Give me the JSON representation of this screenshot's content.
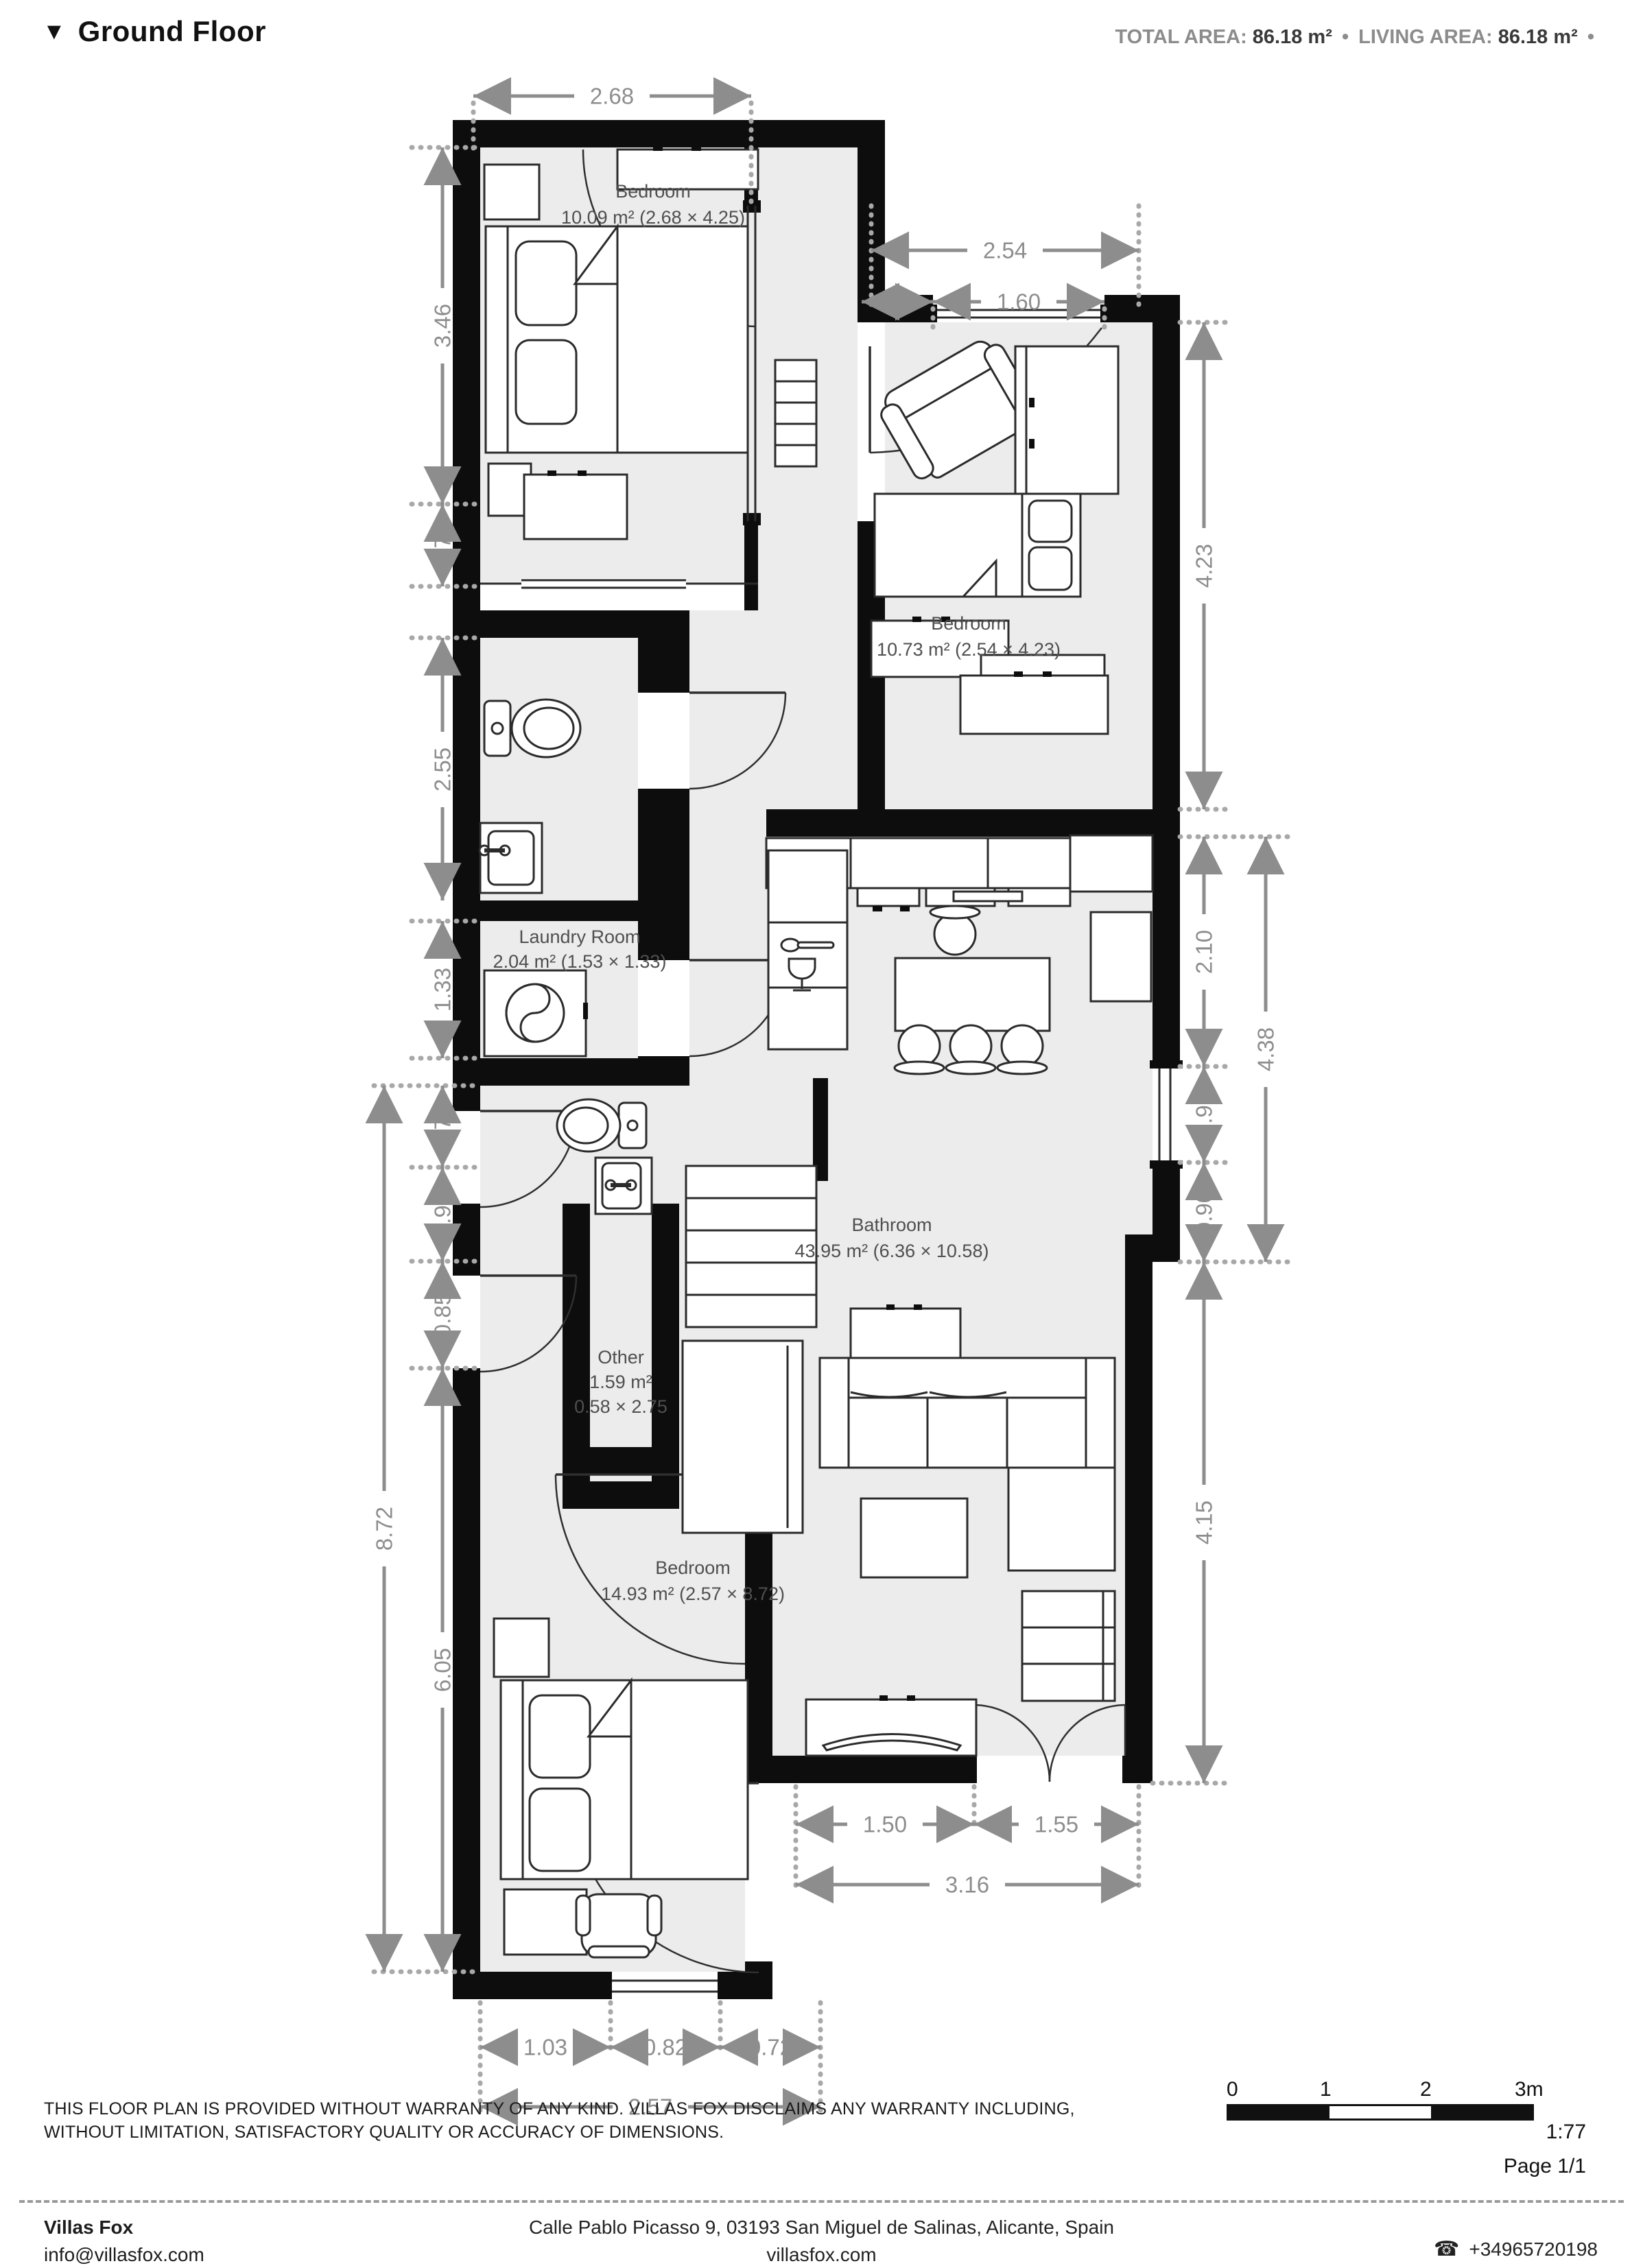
{
  "header": {
    "marker": "▼",
    "title": "Ground Floor",
    "total_label": "TOTAL AREA:",
    "total_value": "86.18 m²",
    "sep": "•",
    "living_label": "LIVING AREA:",
    "living_value": "86.18 m²",
    "trailing_sep": "•"
  },
  "rooms": [
    {
      "name": "Bedroom",
      "size": "10.09 m² (2.68 × 4.25)"
    },
    {
      "name": "Bedroom",
      "size": "10.73 m² (2.54 × 4.23)"
    },
    {
      "name": "Laundry Room",
      "size": "2.04 m² (1.53 × 1.33)"
    },
    {
      "name": "Bathroom",
      "size": "43.95 m² (6.36 × 10.58)"
    },
    {
      "name": "Other",
      "size": "1.59 m²",
      "size2": "0.58 × 2.75"
    },
    {
      "name": "Bedroom",
      "size": "14.93 m² (2.57 × 8.72)"
    }
  ],
  "dims": [
    {
      "v": "2.68"
    },
    {
      "v": "2.54"
    },
    {
      "v": "0.69"
    },
    {
      "v": "1.60"
    },
    {
      "v": "3.46"
    },
    {
      "v": "0.78"
    },
    {
      "v": "2.55"
    },
    {
      "v": "1.33"
    },
    {
      "v": "0.79"
    },
    {
      "v": "0.91"
    },
    {
      "v": "0.85"
    },
    {
      "v": "6.05"
    },
    {
      "v": "8.72"
    },
    {
      "v": "4.23"
    },
    {
      "v": "2.10"
    },
    {
      "v": "0.91"
    },
    {
      "v": "0.90"
    },
    {
      "v": "4.38"
    },
    {
      "v": "4.15"
    },
    {
      "v": "1.50"
    },
    {
      "v": "1.55"
    },
    {
      "v": "3.16"
    },
    {
      "v": "1.03"
    },
    {
      "v": "0.82"
    },
    {
      "v": "0.72"
    },
    {
      "v": "2.57"
    }
  ],
  "footer": {
    "disclaimer_line1": "THIS FLOOR PLAN IS PROVIDED WITHOUT WARRANTY OF ANY KIND. VILLAS FOX DISCLAIMS ANY WARRANTY INCLUDING,",
    "disclaimer_line2": "WITHOUT LIMITATION, SATISFACTORY QUALITY OR ACCURACY OF DIMENSIONS.",
    "scale_tick0": "0",
    "scale_tick1": "1",
    "scale_tick2": "2",
    "scale_tick3": "3m",
    "scale_ratio": "1:77",
    "page": "Page 1/1",
    "company": "Villas Fox",
    "email": "info@villasfox.com",
    "address": "Calle Pablo Picasso 9, 03193 San Miguel de Salinas, Alicante, Spain",
    "website": "villasfox.com",
    "phone_icon": "☎",
    "phone": "+34965720198"
  }
}
